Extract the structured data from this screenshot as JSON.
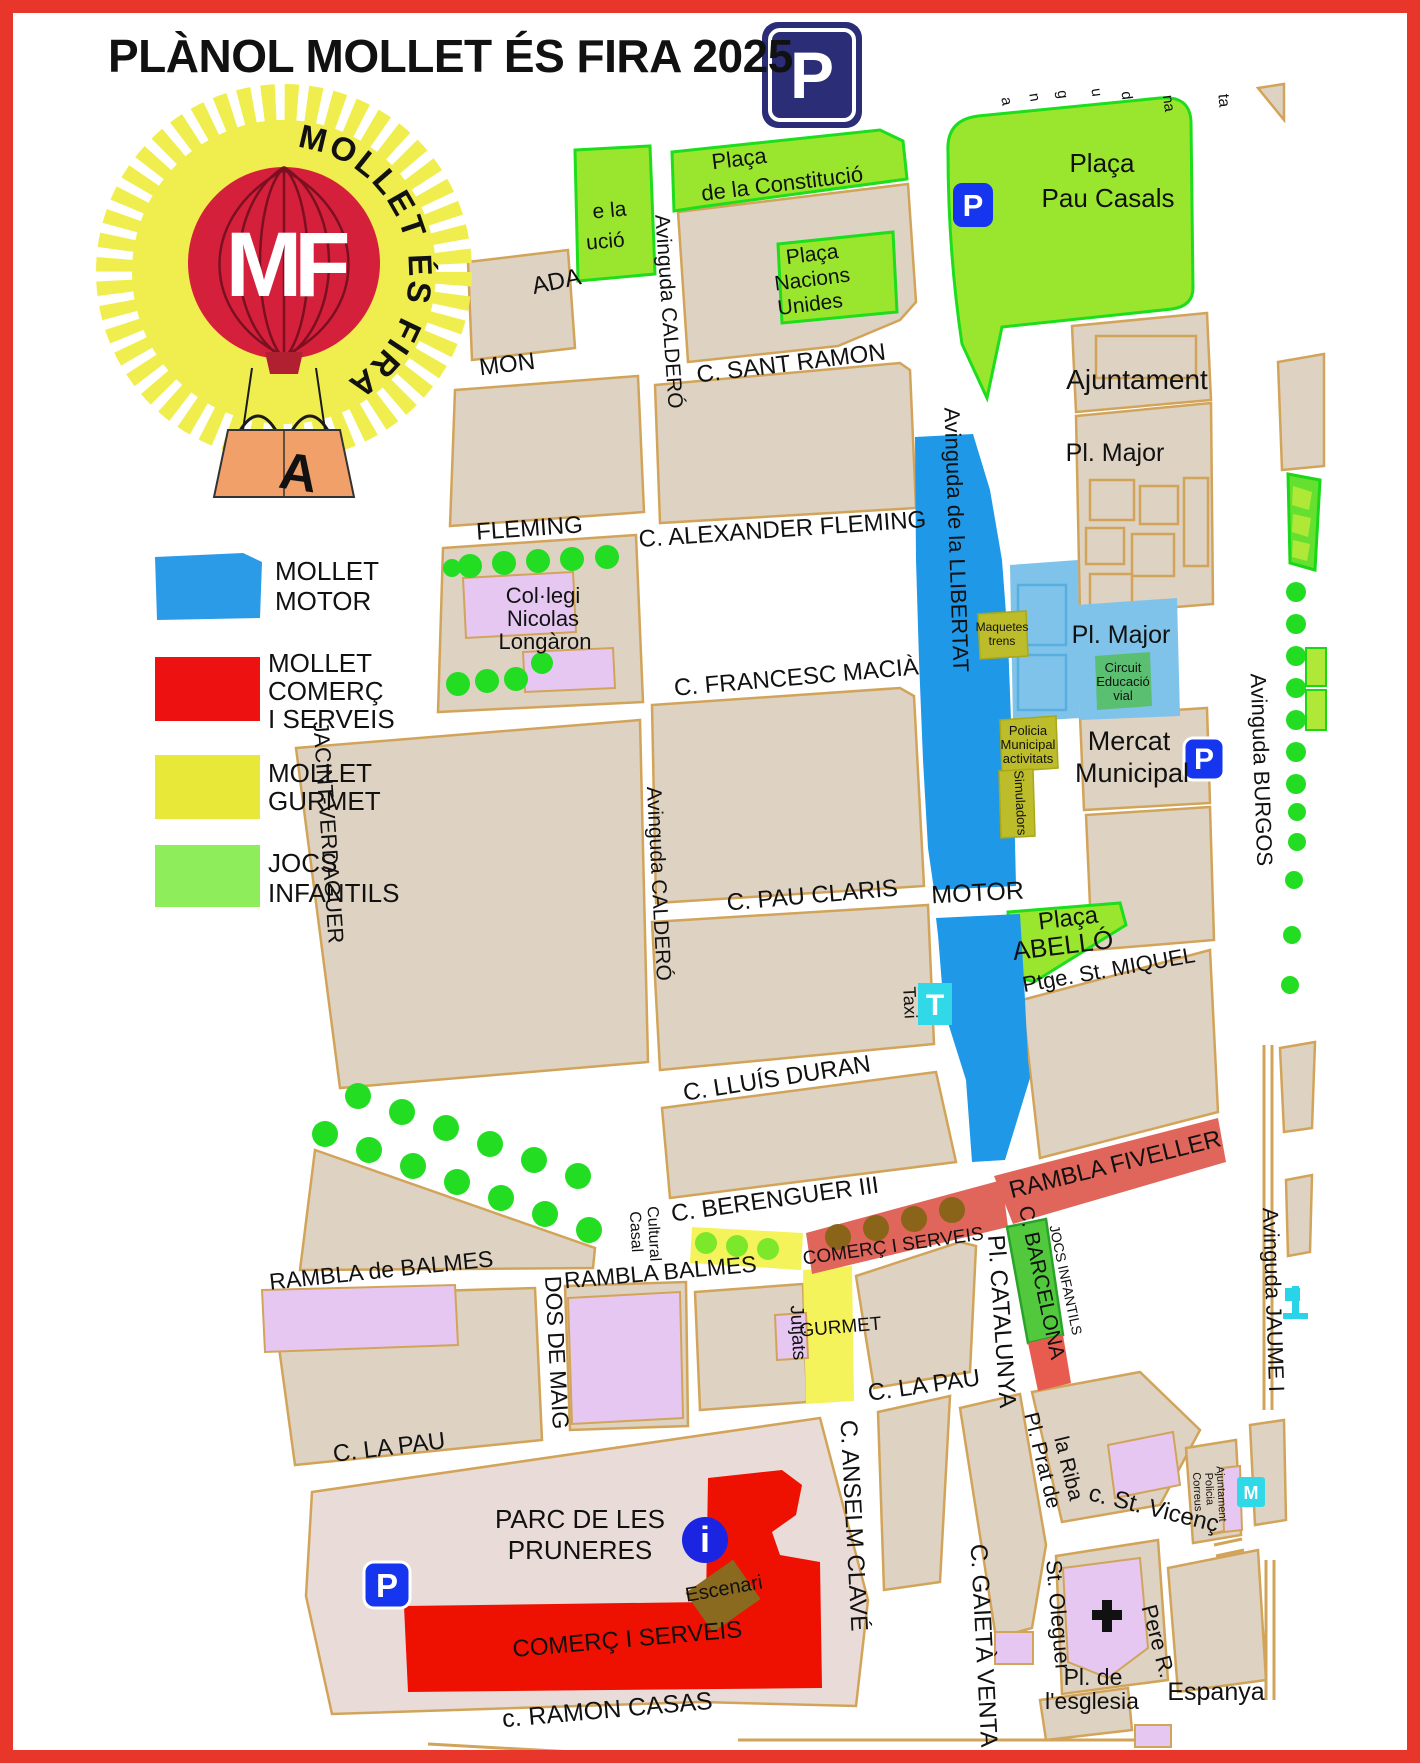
{
  "title": "PLÀNOL MOLLET ÉS FIRA 2025",
  "logo": {
    "monogram": "MF",
    "arc_text": "MOLLET ÉS FIRA",
    "bag_letter": "A"
  },
  "legend": {
    "items": [
      {
        "id": "mollet-motor",
        "color": "#2b9be8",
        "lines": [
          "MOLLET",
          "MOTOR"
        ]
      },
      {
        "id": "mollet-comerc",
        "color": "#ee1111",
        "lines": [
          "MOLLET",
          "COMERÇ",
          "I SERVEIS"
        ]
      },
      {
        "id": "mollet-gurmet",
        "color": "#e8e838",
        "lines": [
          "MOLLET",
          "GURMET"
        ]
      },
      {
        "id": "jocs-infantils",
        "color": "#8ded5a",
        "lines": [
          "JOCS",
          "INFANTILS"
        ]
      }
    ]
  },
  "map": {
    "streets": {
      "sant_ramon": "C. SANT RAMON",
      "alexander": "C. ALEXANDER FLEMING",
      "francesc": "C. FRANCESC MACIÀ",
      "pau_claris": "C. PAU CLARIS",
      "lluis": "C. LLUÍS DURAN",
      "berenguer": "C. BERENGUER III",
      "rambla_de_balmes": "RAMBLA de BALMES",
      "rambla_balmes": "RAMBLA BALMES",
      "la_pau": "C. LA PAU",
      "ramon_casas": "c. RAMON CASAS",
      "caldero": "Avinguda CALDERÓ",
      "llibertat": "Avinguda de la LLIBERTAT",
      "burgos": "Avinguda BURGOS",
      "jaume": "Avinguda JAUME I",
      "jacint": "JACINT-VERDAGUER",
      "dos_de_maig": "DOS DE MAIG",
      "anselm": "C. ANSELM CLAVÉ",
      "gaieta": "C. GAIETÀ VENTA",
      "catalunya": "Pl. CATALUNYA",
      "barcelona": "C. BARCELONA",
      "fiveller": "RAMBLA FIVELLER",
      "ptge": "Ptge. St. MIQUEL",
      "prat_1": "Pl. Prat de",
      "prat_2": "la Riba",
      "st_vicenc": "c. St. Vicenç",
      "st_oleguer": "St. Oleguer",
      "pere": "Pere R.",
      "espanya": "Espanya"
    },
    "places": {
      "constitucio_1": "Plaça",
      "constitucio_2": "de la Constitució",
      "nacions_1": "Plaça",
      "nacions_2": "Nacions",
      "nacions_3": "Unides",
      "pau_casals_1": "Plaça",
      "pau_casals_2": "Pau Casals",
      "ajuntament": "Ajuntament",
      "pl_major": "Pl. Major",
      "pl_major_2": "Pl. Major",
      "circuit_1": "Circuit",
      "circuit_2": "Educació",
      "circuit_3": "vial",
      "maquetes_1": "Maquetes",
      "maquetes_2": "trens",
      "policia_1": "Policia",
      "policia_2": "Municipal",
      "policia_3": "activitats",
      "simuladors": "Simuladors",
      "mercat_1": "Mercat",
      "mercat_2": "Municipal",
      "abello_1": "Plaça",
      "abello_2": "ABELLÓ",
      "collegi_1": "Col·legi",
      "collegi_2": "Nicolas",
      "collegi_3": "Longàron",
      "casal_1": "Casal",
      "casal_2": "Cultural",
      "jutjats": "Jutjats",
      "parc_1": "PARC DE LES",
      "parc_2": "PRUNERES",
      "esglesia_1": "Pl. de",
      "esglesia_2": "l'esglesia",
      "apc_1": "Ajuntament",
      "apc_2": "Policia",
      "apc_3": "Correus"
    },
    "zones": {
      "motor": "MOTOR",
      "gurmet": "GURMET",
      "comerc": "COMERÇ I SERVEIS",
      "jocs": "JOCS INFANTILS",
      "escenari": "Escenari"
    },
    "partials": {
      "mon": "MON",
      "ada": "ADA",
      "fleming": "FLEMING",
      "e_la": "e la",
      "ucio": "ució",
      "ta": "ta",
      "l1": "a",
      "l2": "n",
      "l3": "g",
      "l4": "u",
      "l5": "d",
      "l6": "na"
    },
    "icons": {
      "p": "P",
      "i": "i",
      "t": "T",
      "taxi": "Taxi",
      "m": "M"
    }
  },
  "colors": {
    "frame": "#e8362a",
    "block": "#ded2c3",
    "block_stroke": "#d2a45a",
    "purple": "#e5c7f2",
    "green": "#9ae62e",
    "motor_blue": "#1f98e8",
    "light_blue": "#7fc3ea",
    "salmon": "#e0655a",
    "red": "#ee1102",
    "yellow": "#f5f35c",
    "olive": "#bdbd2b",
    "barcelona_green": "#52c93c",
    "parc": "#e9dcd8",
    "navy_sign": "#2b2d77",
    "icon_blue": "#1535ee",
    "cyan": "#30d8e8",
    "balloon_red": "#d5203c",
    "starburst_yellow": "#f0ee4e"
  }
}
